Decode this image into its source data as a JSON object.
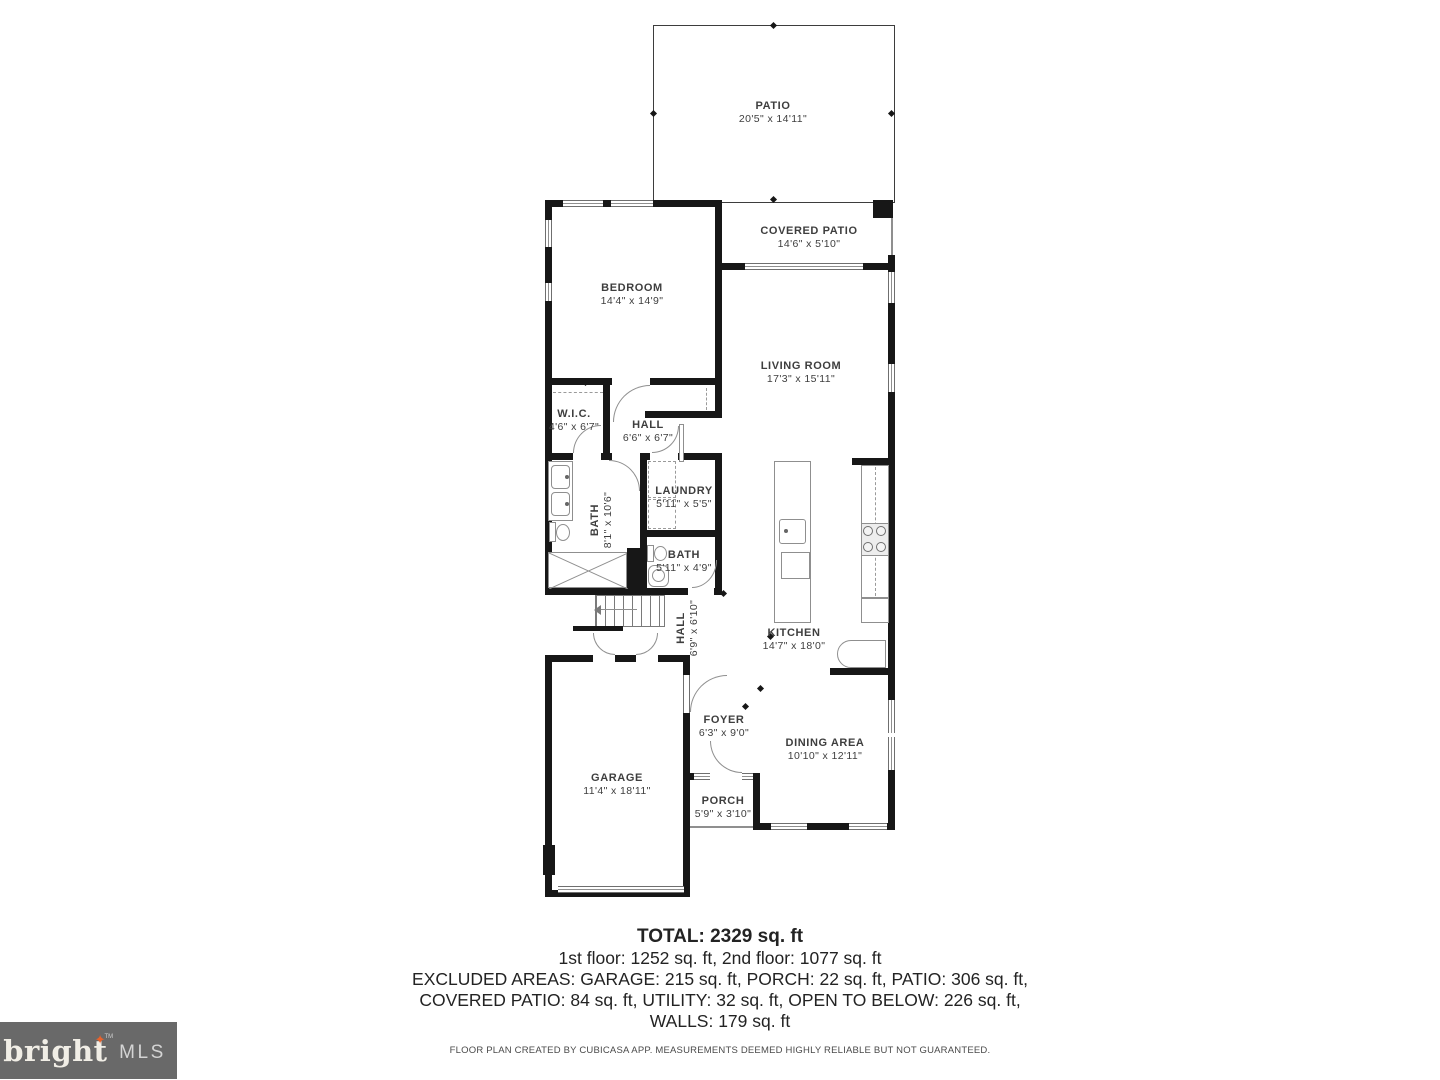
{
  "rooms": {
    "patio": {
      "name": "PATIO",
      "dims": "20'5\" x 14'11\""
    },
    "covered_patio": {
      "name": "COVERED PATIO",
      "dims": "14'6\" x 5'10\""
    },
    "bedroom": {
      "name": "BEDROOM",
      "dims": "14'4\" x 14'9\""
    },
    "living_room": {
      "name": "LIVING ROOM",
      "dims": "17'3\" x 15'11\""
    },
    "wic": {
      "name": "W.I.C.",
      "dims": "4'6\" x 6'7\""
    },
    "hall_upper": {
      "name": "HALL",
      "dims": "6'6\" x 6'7\""
    },
    "bath_main": {
      "name": "BATH",
      "dims": "8'1\" x 10'6\""
    },
    "laundry": {
      "name": "LAUNDRY",
      "dims": "5'11\" x 5'5\""
    },
    "bath_small": {
      "name": "BATH",
      "dims": "5'11\" x 4'9\""
    },
    "kitchen": {
      "name": "KITCHEN",
      "dims": "14'7\" x 18'0\""
    },
    "hall_lower": {
      "name": "HALL",
      "dims": "6'9\" x 6'10\""
    },
    "garage": {
      "name": "GARAGE",
      "dims": "11'4\" x 18'11\""
    },
    "foyer": {
      "name": "FOYER",
      "dims": "6'3\" x 9'0\""
    },
    "dining": {
      "name": "DINING AREA",
      "dims": "10'10\" x 12'11\""
    },
    "porch": {
      "name": "PORCH",
      "dims": "5'9\" x 3'10\""
    }
  },
  "summary": {
    "total": "TOTAL: 2329 sq. ft",
    "floors": "1st floor: 1252 sq. ft, 2nd floor: 1077 sq. ft",
    "excluded1": "EXCLUDED AREAS: GARAGE: 215 sq. ft, PORCH: 22 sq. ft, PATIO: 306 sq. ft,",
    "excluded2": "COVERED PATIO: 84 sq. ft, UTILITY: 32 sq. ft, OPEN TO BELOW: 226 sq. ft,",
    "excluded3": "WALLS: 179 sq. ft"
  },
  "disclaimer": "FLOOR PLAN CREATED BY CUBICASA APP. MEASUREMENTS DEEMED HIGHLY RELIABLE BUT NOT GUARANTEED.",
  "logo": {
    "brand": "bright",
    "tm": "TM",
    "suffix": "MLS"
  },
  "colors": {
    "wall": "#171717",
    "fixture": "#8f8f8f",
    "label": "#3e3e3e",
    "logo_bg": "#696969",
    "logo_star": "#e8622b"
  }
}
